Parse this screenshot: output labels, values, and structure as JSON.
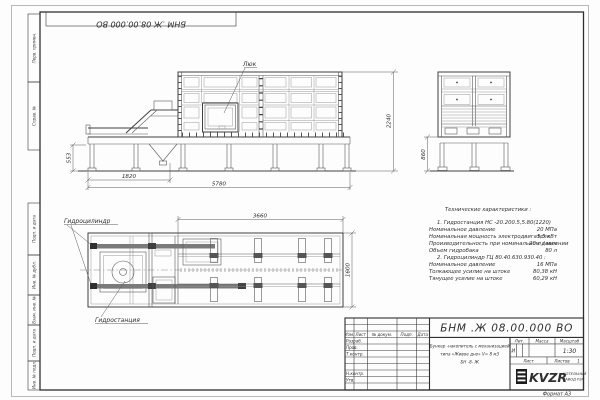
{
  "meta": {
    "format_note": "Формат  А3"
  },
  "colors": {
    "paper": "#fdfdfd",
    "frame": "#2e2e2e",
    "object_line": "#3f3f3f",
    "thin_line": "#8f8f8f",
    "text": "#2f2f2f",
    "logo_black": "#1c1c1c"
  },
  "top_stamp": {
    "designation": "БНМ .Ж 08.00.000  ВО"
  },
  "side_graphs": {
    "perv_primen": "Перв. примен.",
    "sprav_no": "Справ. №",
    "podp_data_1": "Подп. и дата",
    "inv_dubl": "Инв. № дубл.",
    "vzam_inv": "Взам. инв. №",
    "podp_data_2": "Подп. и дата",
    "inv_podl": "Инв. № подл."
  },
  "front_view": {
    "hatch_label": "Люк",
    "dim_base_height": "553",
    "dim_left_span": "1820",
    "dim_total_span": "5780",
    "dim_total_height": "2240"
  },
  "side_view": {
    "dim_base_height": "860"
  },
  "plan_view": {
    "cylinder_label": "Гидроцилиндр",
    "station_label": "Гидростанция",
    "dim_span": "3660",
    "dim_width": "1600"
  },
  "tech_specs": {
    "title": "Технические характеристики :",
    "lines": [
      {
        "label": "1.  Гидростанция НС -20.200.5,5.80(1220)",
        "value": ""
      },
      {
        "label": "Номинальное давление",
        "value": "20  МПа"
      },
      {
        "label": "Номинальная мощность электродвигателя",
        "value": "5,5  кВт"
      },
      {
        "label": "Производительность при номинальном давлении",
        "value": "20  л / мин"
      },
      {
        "label": "Объем гидробака",
        "value": "80  л"
      },
      {
        "label": "2.  Гидроцилиндр ГЦ 80.40.630.930.40 :",
        "value": ""
      },
      {
        "label": "Номинальное давление",
        "value": "16  МПа"
      },
      {
        "label": "Толкающее усилие на штоке",
        "value": "80,38  кН"
      },
      {
        "label": "Тянущее усилие на штоке",
        "value": "60,29  кН"
      }
    ]
  },
  "title_block": {
    "designation": "БНМ .Ж 08.00.000  ВО",
    "name_lines": [
      "Бункер -накопитель с механизацией",
      "типа «Живое дно» V= 8  м3",
      "БН -8- Ж"
    ],
    "header_cols": [
      "Изм.",
      "Лист",
      "№ докум.",
      "Подп.",
      "Дата"
    ],
    "role_rows": [
      "Разраб.",
      "Пров.",
      "Т.контр.",
      "Н.контр.",
      "Утв."
    ],
    "lit_header": "Лит.",
    "mass_header": "Масса",
    "scale_header": "Масштаб",
    "lit_value": "И",
    "scale_value": "1:30",
    "sheet_label": "Лист",
    "sheets_label": "Листов",
    "sheets_value": "1",
    "logo": {
      "abbr": "KVZR",
      "sub1": "КОТЕЛЬНЫЙ",
      "sub2": "ЗАВОД РЭП"
    }
  }
}
